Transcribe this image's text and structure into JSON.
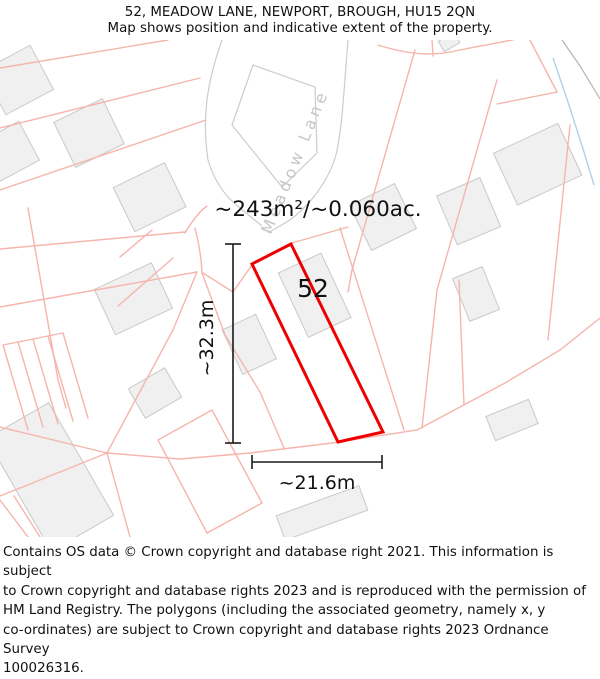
{
  "header": {
    "title": "52, MEADOW LANE, NEWPORT, BROUGH, HU15 2QN",
    "subtitle": "Map shows position and indicative extent of the property."
  },
  "map": {
    "street_label": "Meadow Lane",
    "plot_number": "52",
    "area_label": "~243m²/~0.060ac.",
    "width_label": "~21.6m",
    "height_label": "~32.3m",
    "colors": {
      "highlight": "#ee0000",
      "parcel_line": "#f5b5ad",
      "building_fill": "#f0f0f0",
      "building_stroke": "#c9c9c9",
      "road_stroke": "#cccccc",
      "water": "#aed3e8",
      "dimension": "#1a1a1a",
      "street_text": "#c6c6c6"
    }
  },
  "footer": {
    "lines": [
      "Contains OS data © Crown copyright and database right 2021. This information is subject",
      "to Crown copyright and database rights 2023 and is reproduced with the permission of",
      "HM Land Registry. The polygons (including the associated geometry, namely x, y",
      "co-ordinates) are subject to Crown copyright and database rights 2023 Ordnance Survey",
      "100026316."
    ]
  }
}
